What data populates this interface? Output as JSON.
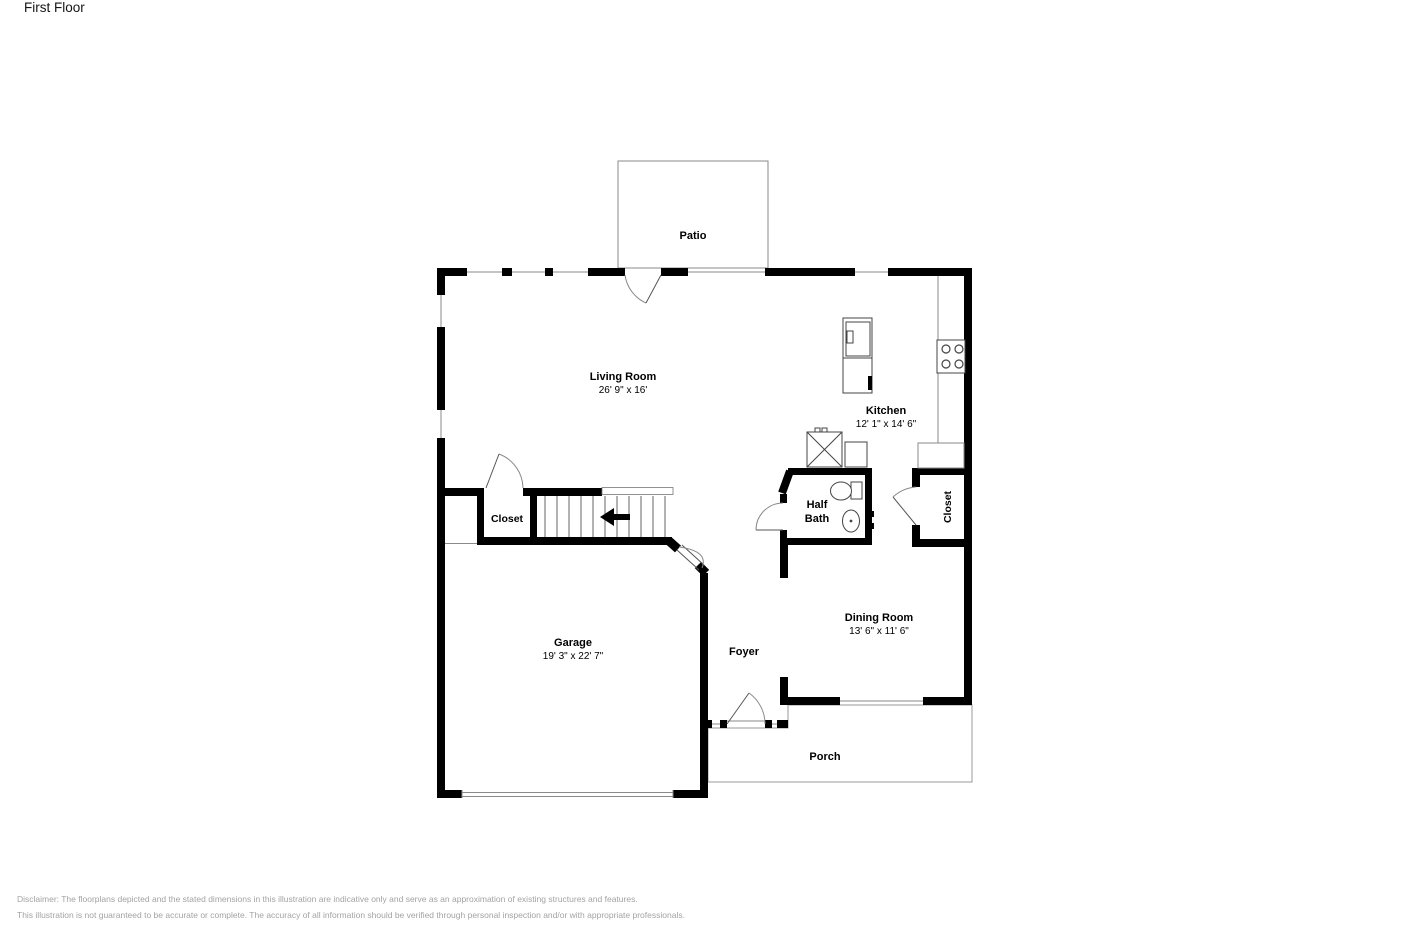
{
  "title": "First Floor",
  "rooms": {
    "patio": {
      "name": "Patio"
    },
    "living_room": {
      "name": "Living Room",
      "dims": "26' 9\" x 16'"
    },
    "kitchen": {
      "name": "Kitchen",
      "dims": "12' 1\" x 14' 6\""
    },
    "half_bath": {
      "name_line1": "Half",
      "name_line2": "Bath"
    },
    "closet_left": {
      "name": "Closet"
    },
    "closet_right": {
      "name": "Closet"
    },
    "garage": {
      "name": "Garage",
      "dims": "19' 3\" x 22' 7\""
    },
    "foyer": {
      "name": "Foyer"
    },
    "dining_room": {
      "name": "Dining Room",
      "dims": "13' 6\" x 11' 6\""
    },
    "porch": {
      "name": "Porch"
    }
  },
  "disclaimer": {
    "line1": "Disclaimer: The floorplans depicted and the stated dimensions in this illustration are indicative only and serve as an approximation of existing structures and features.",
    "line2": "This illustration is not guaranteed to be accurate or complete. The accuracy of all information should be verified through personal inspection and/or with appropriate professionals."
  },
  "colors": {
    "wall": "#000000",
    "outline": "#888888",
    "fixture": "#444444",
    "label_text": "#000000",
    "disclaimer_text": "#a3a3a3"
  }
}
